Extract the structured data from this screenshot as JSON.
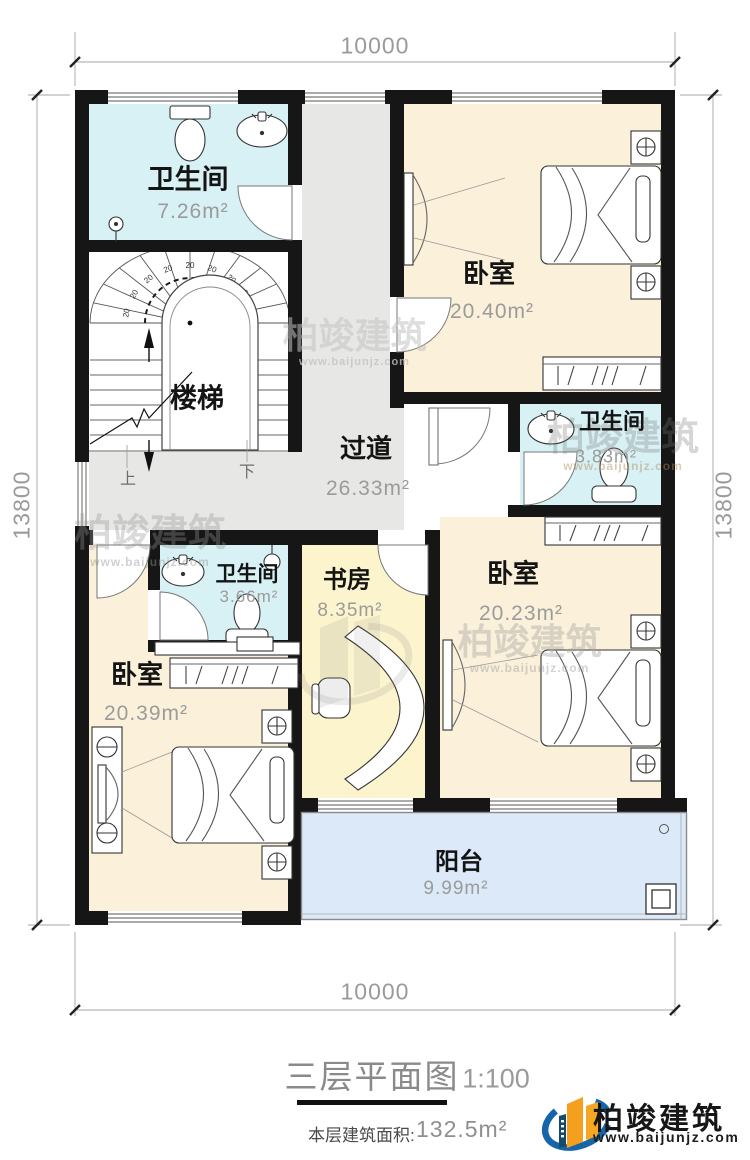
{
  "rooms": {
    "bath_top": {
      "name": "卫生间",
      "area": "7.26m²"
    },
    "stairs": {
      "name": "楼梯",
      "up": "上",
      "down": "下",
      "tread": "20"
    },
    "bedroom_tr": {
      "name": "卧室",
      "area": "20.40m²"
    },
    "corridor": {
      "name": "过道",
      "area": "26.33m²"
    },
    "bath_mid": {
      "name": "卫生间",
      "area": "3.83m²"
    },
    "bedroom_r": {
      "name": "卧室",
      "area": "20.23m²"
    },
    "bath_left": {
      "name": "卫生间",
      "area": "3.66m²"
    },
    "study": {
      "name": "书房",
      "area": "8.35m²"
    },
    "bedroom_bl": {
      "name": "卧室",
      "area": "20.39m²"
    },
    "balcony": {
      "name": "阳台",
      "area": "9.99m²"
    }
  },
  "dimensions": {
    "top": "10000",
    "bottom": "10000",
    "left": "13800",
    "right": "13800"
  },
  "title": {
    "text": "三层平面图",
    "scale": "1:100",
    "area_label": "本层建筑面积:",
    "area_value": "132.5m²"
  },
  "brand": {
    "company": "柏竣建筑",
    "website": "www.baijunjz.com"
  },
  "colors": {
    "wall": "#161616",
    "bathroom_fill": "#d8f1f5",
    "bedroom_fill": "#fbf1da",
    "study_fill": "#fcf4cd",
    "corridor_fill": "#e7e7e5",
    "balcony_fill": "#dbe9f8",
    "dim_text": "#9a9a9a",
    "logo_blue": "#1565a8",
    "logo_orange": "#f59f1f"
  }
}
